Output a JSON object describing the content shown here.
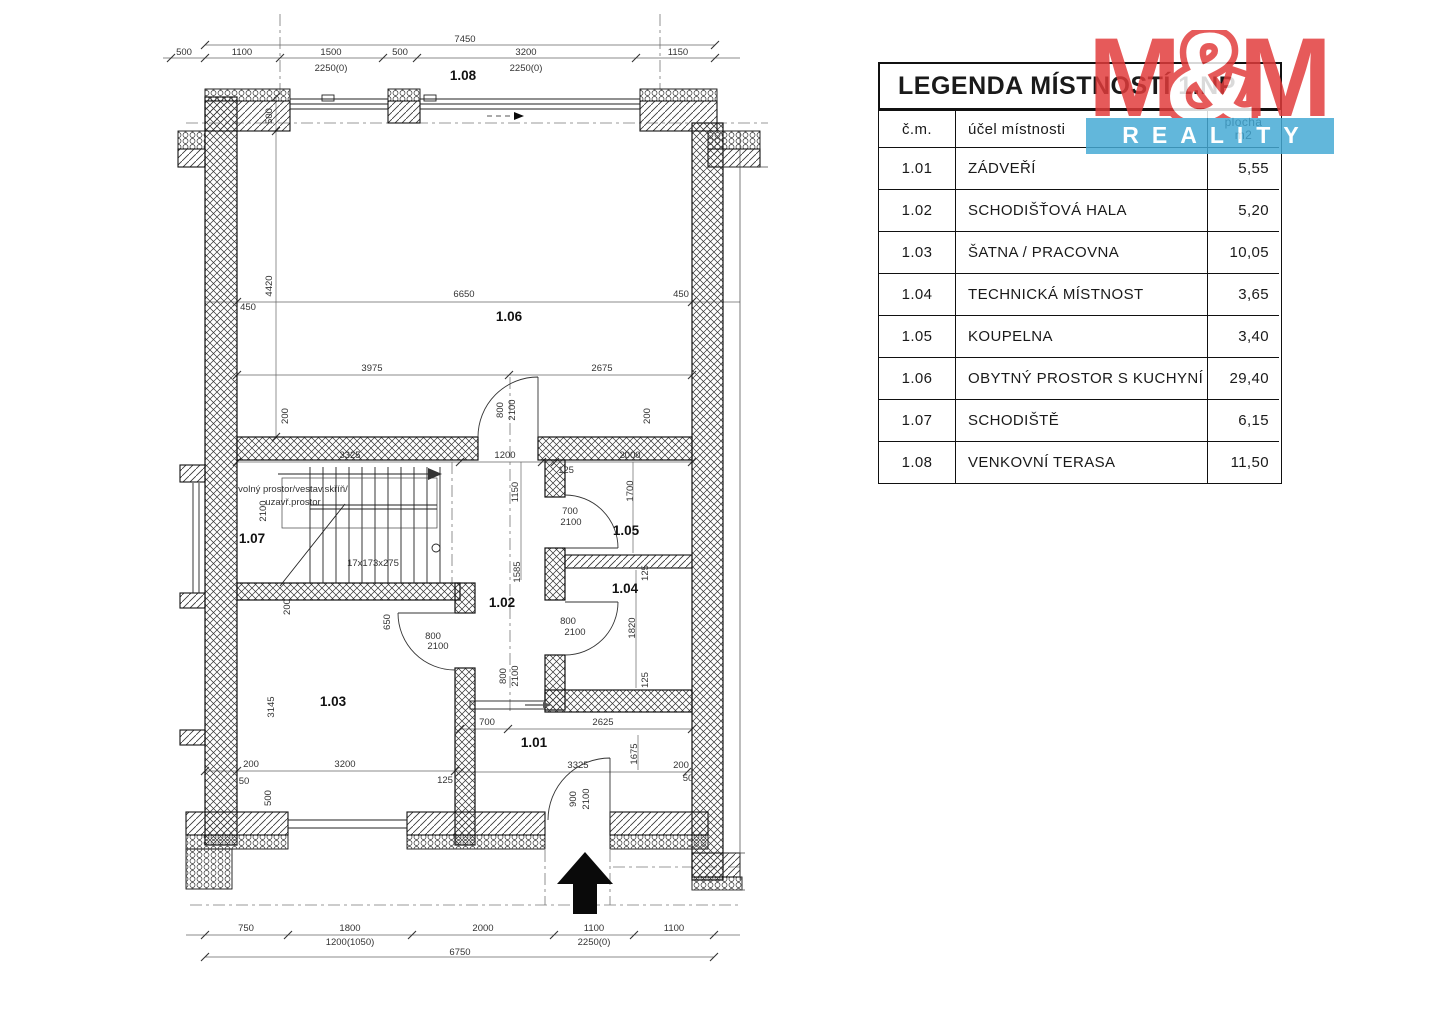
{
  "legend": {
    "title": "LEGENDA MÍSTNOSTÍ 1.NP",
    "col_num": "č.m.",
    "col_name": "účel místnosti",
    "col_area_line1": "plocha",
    "col_area_line2": "m2",
    "rows": [
      {
        "num": "1.01",
        "name": "ZÁDVEŘÍ",
        "area": "5,55"
      },
      {
        "num": "1.02",
        "name": "SCHODIŠŤOVÁ HALA",
        "area": "5,20"
      },
      {
        "num": "1.03",
        "name": "ŠATNA / PRACOVNA",
        "area": "10,05"
      },
      {
        "num": "1.04",
        "name": "TECHNICKÁ MÍSTNOST",
        "area": "3,65"
      },
      {
        "num": "1.05",
        "name": "KOUPELNA",
        "area": "3,40"
      },
      {
        "num": "1.06",
        "name": "OBYTNÝ PROSTOR S KUCHYNÍ",
        "area": "29,40"
      },
      {
        "num": "1.07",
        "name": "SCHODIŠTĚ",
        "area": "6,15"
      },
      {
        "num": "1.08",
        "name": "VENKOVNÍ TERASA",
        "area": "11,50"
      }
    ]
  },
  "logo": {
    "m1": "M",
    "amp": "&",
    "m2": "M",
    "reality": "REALITY",
    "red": "#e23b3b",
    "blue": "#45aad5"
  },
  "plan": {
    "stair_formula": "17x173x275",
    "labels": [
      {
        "t": "7450",
        "x": 465,
        "y": 42
      },
      {
        "t": "500",
        "x": 184,
        "y": 55
      },
      {
        "t": "1100",
        "x": 242,
        "y": 55
      },
      {
        "t": "1500",
        "x": 331,
        "y": 55
      },
      {
        "t": "2250(0)",
        "x": 331,
        "y": 71,
        "s": 8.5
      },
      {
        "t": "500",
        "x": 400,
        "y": 55
      },
      {
        "t": "3200",
        "x": 526,
        "y": 55
      },
      {
        "t": "2250(0)",
        "x": 526,
        "y": 71,
        "s": 8.5
      },
      {
        "t": "1150",
        "x": 678,
        "y": 55
      },
      {
        "t": "1.08",
        "x": 463,
        "y": 80,
        "b": 1
      },
      {
        "t": "500",
        "x": 272,
        "y": 116,
        "r": 1,
        "s": 8.5
      },
      {
        "t": "4420",
        "x": 272,
        "y": 286,
        "r": 1,
        "s": 8.5
      },
      {
        "t": "450",
        "x": 248,
        "y": 310,
        "s": 8.5
      },
      {
        "t": "6650",
        "x": 464,
        "y": 297
      },
      {
        "t": "450",
        "x": 681,
        "y": 297,
        "s": 8.5
      },
      {
        "t": "1.06",
        "x": 509,
        "y": 321,
        "b": 1
      },
      {
        "t": "3975",
        "x": 372,
        "y": 371
      },
      {
        "t": "2675",
        "x": 602,
        "y": 371
      },
      {
        "t": "200",
        "x": 288,
        "y": 416,
        "r": 1,
        "s": 8.5
      },
      {
        "t": "800",
        "x": 503,
        "y": 410,
        "r": 1,
        "s": 8.5
      },
      {
        "t": "2100",
        "x": 515,
        "y": 410,
        "r": 1,
        "s": 8.5
      },
      {
        "t": "200",
        "x": 650,
        "y": 416,
        "r": 1,
        "s": 8.5
      },
      {
        "t": "3325",
        "x": 350,
        "y": 458
      },
      {
        "t": "1200",
        "x": 505,
        "y": 458
      },
      {
        "t": "1150",
        "x": 518,
        "y": 492,
        "r": 1,
        "s": 8.5
      },
      {
        "t": "volný prostor/vestav.skříň/",
        "x": 293,
        "y": 492,
        "a": "start",
        "s": 10
      },
      {
        "t": "uzavř.prostor",
        "x": 293,
        "y": 505,
        "a": "start",
        "s": 10
      },
      {
        "t": "2100",
        "x": 266,
        "y": 511,
        "r": 1,
        "s": 8.5
      },
      {
        "t": "1.07",
        "x": 252,
        "y": 543,
        "b": 1
      },
      {
        "t": "17x173x275",
        "x": 373,
        "y": 566,
        "s": 10
      },
      {
        "t": "1585",
        "x": 520,
        "y": 572,
        "r": 1,
        "s": 8.5
      },
      {
        "t": "1.02",
        "x": 502,
        "y": 607,
        "b": 1
      },
      {
        "t": "2000",
        "x": 630,
        "y": 458
      },
      {
        "t": "125",
        "x": 566,
        "y": 473,
        "s": 8.5
      },
      {
        "t": "1700",
        "x": 633,
        "y": 491,
        "r": 1,
        "s": 8.5
      },
      {
        "t": "700",
        "x": 570,
        "y": 514,
        "s": 8.5
      },
      {
        "t": "2100",
        "x": 571,
        "y": 525,
        "s": 8.5
      },
      {
        "t": "1.05",
        "x": 626,
        "y": 535,
        "b": 1
      },
      {
        "t": "125",
        "x": 648,
        "y": 573,
        "r": 1,
        "s": 8.5
      },
      {
        "t": "1.04",
        "x": 625,
        "y": 593,
        "b": 1
      },
      {
        "t": "800",
        "x": 568,
        "y": 624,
        "s": 8.5
      },
      {
        "t": "2100",
        "x": 575,
        "y": 635,
        "s": 8.5
      },
      {
        "t": "1820",
        "x": 635,
        "y": 628,
        "r": 1,
        "s": 8.5
      },
      {
        "t": "125",
        "x": 648,
        "y": 680,
        "r": 1,
        "s": 8.5
      },
      {
        "t": "800",
        "x": 506,
        "y": 676,
        "r": 1,
        "s": 8.5
      },
      {
        "t": "2100",
        "x": 518,
        "y": 676,
        "r": 1,
        "s": 8.5
      },
      {
        "t": "200",
        "x": 290,
        "y": 607,
        "r": 1,
        "s": 8.5
      },
      {
        "t": "650",
        "x": 390,
        "y": 622,
        "r": 1,
        "s": 8.5
      },
      {
        "t": "800",
        "x": 433,
        "y": 639,
        "s": 8.5
      },
      {
        "t": "2100",
        "x": 438,
        "y": 649,
        "s": 8.5
      },
      {
        "t": "3145",
        "x": 274,
        "y": 707,
        "r": 1,
        "s": 8.5
      },
      {
        "t": "1.03",
        "x": 333,
        "y": 706,
        "b": 1
      },
      {
        "t": "200",
        "x": 251,
        "y": 767,
        "s": 8.5
      },
      {
        "t": "3200",
        "x": 345,
        "y": 767
      },
      {
        "t": "50",
        "x": 244,
        "y": 784,
        "s": 8.5
      },
      {
        "t": "500",
        "x": 271,
        "y": 798,
        "r": 1,
        "s": 8.5
      },
      {
        "t": "125",
        "x": 445,
        "y": 783,
        "s": 8.5
      },
      {
        "t": "700",
        "x": 487,
        "y": 725,
        "s": 8.5
      },
      {
        "t": "2625",
        "x": 603,
        "y": 725
      },
      {
        "t": "1.01",
        "x": 534,
        "y": 747,
        "b": 1
      },
      {
        "t": "3325",
        "x": 578,
        "y": 768
      },
      {
        "t": "1675",
        "x": 637,
        "y": 754,
        "r": 1,
        "s": 8.5
      },
      {
        "t": "200",
        "x": 681,
        "y": 768,
        "s": 8.5
      },
      {
        "t": "50",
        "x": 688,
        "y": 781,
        "s": 8.5
      },
      {
        "t": "900",
        "x": 576,
        "y": 799,
        "r": 1,
        "s": 8.5
      },
      {
        "t": "2100",
        "x": 589,
        "y": 799,
        "r": 1,
        "s": 8.5
      },
      {
        "t": "750",
        "x": 246,
        "y": 931
      },
      {
        "t": "1800",
        "x": 350,
        "y": 931
      },
      {
        "t": "1200(1050)",
        "x": 350,
        "y": 945,
        "s": 8.5
      },
      {
        "t": "2000",
        "x": 483,
        "y": 931
      },
      {
        "t": "1100",
        "x": 594,
        "y": 931
      },
      {
        "t": "2250(0)",
        "x": 594,
        "y": 945,
        "s": 8.5
      },
      {
        "t": "1100",
        "x": 674,
        "y": 931
      },
      {
        "t": "6750",
        "x": 460,
        "y": 955
      }
    ]
  }
}
